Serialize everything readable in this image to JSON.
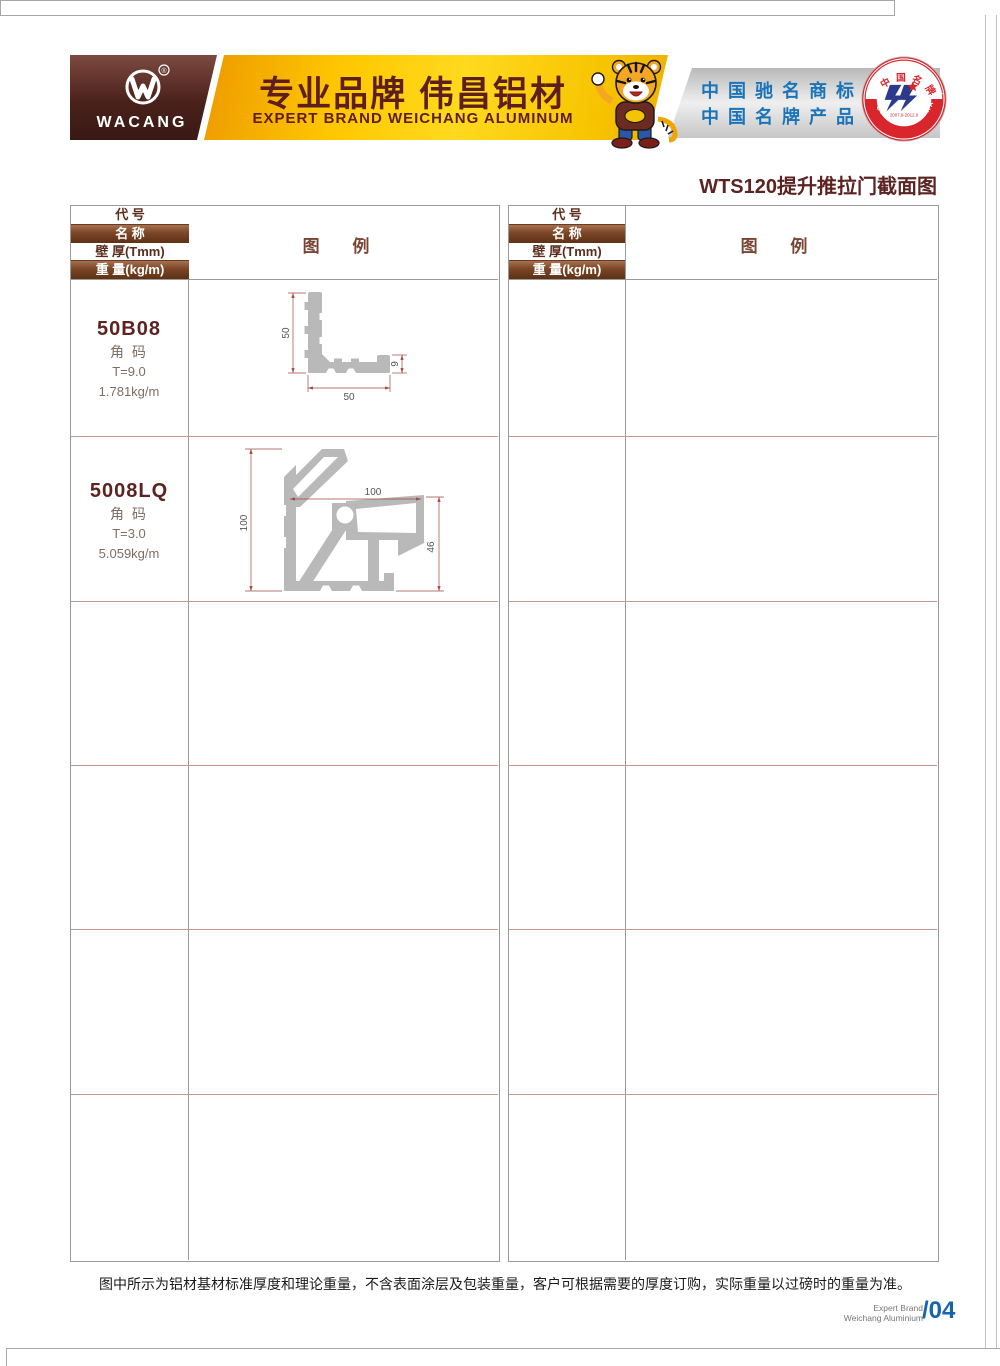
{
  "header": {
    "logo_text": "WACANG",
    "registered_mark": "®",
    "banner_title": "专业品牌  伟昌铝材",
    "banner_subtitle": "EXPERT BRAND WEICHANG ALUMINUM",
    "right_line1": "中国驰名商标",
    "right_line2": "中国名牌产品",
    "badge": {
      "top_text": "中国名牌",
      "bottom_text": "CHINA TOP BRAND",
      "period": "2007.9-2012.9"
    },
    "colors": {
      "brand_brown": "#4a211b",
      "banner_gold": "#ffd300",
      "accent_blue": "#1b74b8",
      "badge_red": "#d8262c"
    }
  },
  "page": {
    "title": "WTS120提升推拉门截面图",
    "footer_note": "图中所示为铝材基材标准厚度和理论重量，不含表面涂层及包装重量，客户可根据需要的厚度订购，实际重量以过磅时的重量为准。",
    "footer_brand_line1": "Expert Brand",
    "footer_brand_line2": "Weichang Aluminium",
    "page_number": "/04"
  },
  "table_header": {
    "rows": [
      "代 号",
      "名 称",
      "壁 厚(Tmm)",
      "重 量(kg/m)"
    ],
    "legend": "图  例"
  },
  "profiles": [
    {
      "code": "50B08",
      "name": "角 码",
      "thickness": "T=9.0",
      "weight": "1.781kg/m",
      "dims": {
        "height": "50",
        "width": "50",
        "end": "9"
      }
    },
    {
      "code": "5008LQ",
      "name": "角 码",
      "thickness": "T=3.0",
      "weight": "5.059kg/m",
      "dims": {
        "height": "100",
        "width": "100",
        "end": "46"
      }
    }
  ]
}
